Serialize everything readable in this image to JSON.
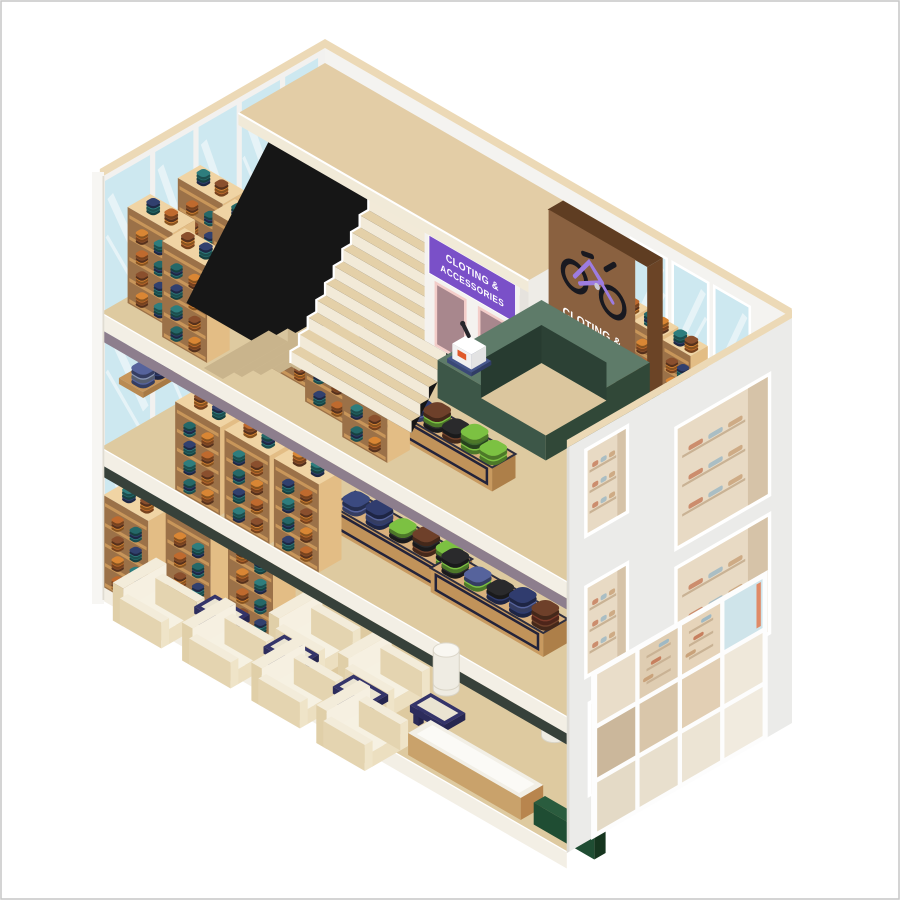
{
  "signs": {
    "elevator_sign": {
      "line1": "CLOTING &",
      "line2": "ACCESSORIES"
    },
    "brand_board": {
      "line1": "CLOTING &",
      "line2": "ACCESSORIES"
    }
  },
  "palette": {
    "floor": "#decaa0",
    "deck": "#e3cda6",
    "slab_face": "#f3efe5",
    "slab_accent_top": "#8d7e8d",
    "slab_accent_mid": "#37413a",
    "wall": "#f2f1ef",
    "wall_edge_cream": "#ecd9b6",
    "glass": "#cde8f0",
    "stairwell_black": "#161616",
    "stair_tread": "#e4d0a8",
    "stair_riser": "#f2ead8",
    "wood_top": "#f0d4a4",
    "wood_side": "#e3bd85",
    "wood_front": "#c8965a",
    "wood_recess": "#9b7148",
    "counter_top": "#5e7b69",
    "counter_front": "#3d5748",
    "counter_side": "#314838",
    "sign_purple": "#7a50c8",
    "door_mauve": "#a8878d",
    "door_frame": "#f3cdc9",
    "board_brown": "#8a6140",
    "board_side": "#6b4426",
    "bike_purple": "#9d7ce0",
    "bike_black": "#191920",
    "chair_body": "#e9dcbd",
    "chair_light": "#f3ecda",
    "table_navy": "#34346a",
    "table_top_cream": "#eae4d2",
    "accent_green": "#1f4d33",
    "bin_white": "#efece3",
    "shelf_clothes": [
      "#d98634",
      "#2e7d7d",
      "#8a4f2d",
      "#31406e",
      "#bf6a2e",
      "#256868"
    ],
    "stack_clothes": {
      "navy": "#303c6e",
      "blue": "#56639c",
      "steel": "#8b97b5",
      "lime": "#7cc142",
      "green": "#3f6b2e",
      "black": "#2a2a2c",
      "brown": "#6e402a",
      "maroon": "#7c3b2a"
    }
  },
  "inventory": {
    "floors": [
      {
        "name": "top floor",
        "items": [
          "wardrobe shelves",
          "elevators",
          "staircase",
          "brand board",
          "checkout counter",
          "display table"
        ]
      },
      {
        "name": "middle floor",
        "items": [
          "wardrobe shelves",
          "display tables",
          "wall shelf",
          "bin"
        ]
      },
      {
        "name": "ground floor",
        "items": [
          "wardrobe shelves",
          "armchairs",
          "coffee tables",
          "display bench",
          "bin",
          "storefront windows"
        ]
      }
    ]
  }
}
